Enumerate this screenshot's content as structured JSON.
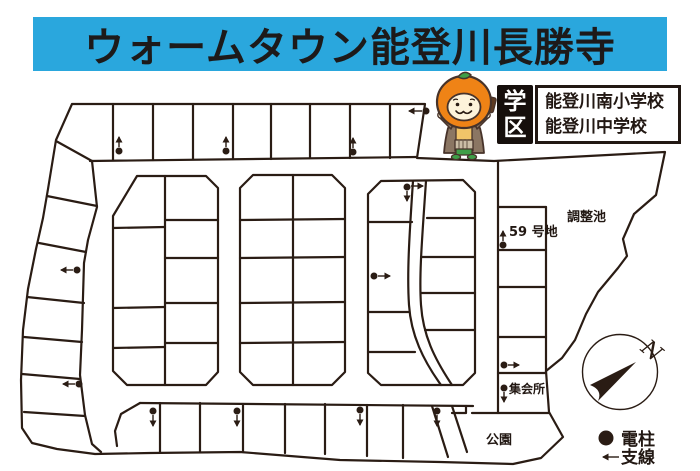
{
  "banner": {
    "title": "ウォームタウン能登川長勝寺",
    "bg_color": "#2aa7dd"
  },
  "school_district": {
    "badge_line1": "学",
    "badge_line2": "区",
    "schools": [
      "能登川南小学校",
      "能登川中学校"
    ]
  },
  "map": {
    "labels": {
      "pond": "調整池",
      "lot59": "59 号地",
      "meeting_hall": "集会所",
      "park": "公園"
    },
    "compass_letter": "N",
    "legend": {
      "pole": "電柱",
      "wire": "支線"
    }
  },
  "colors": {
    "banner_bg": "#2aa7dd",
    "line": "#2a1c14",
    "mascot_orange": "#ef8316"
  }
}
